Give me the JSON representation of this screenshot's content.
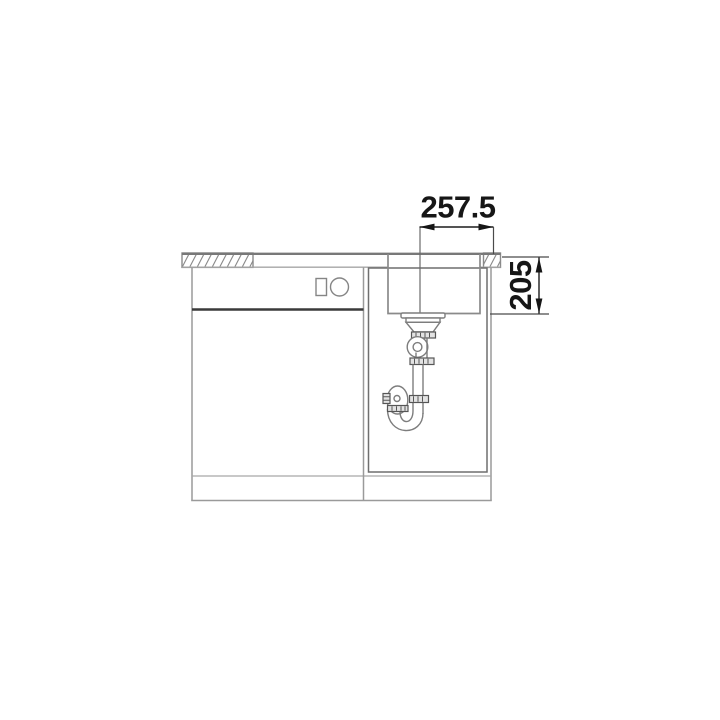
{
  "drawing": {
    "dimensions": {
      "horizontal": {
        "label": "257.5"
      },
      "vertical": {
        "label": "205"
      }
    }
  },
  "colors": {
    "background": "#ffffff",
    "line_gray": "#8a8a8a",
    "line_dark": "#3a3a3a",
    "dimension_black": "#161616"
  }
}
